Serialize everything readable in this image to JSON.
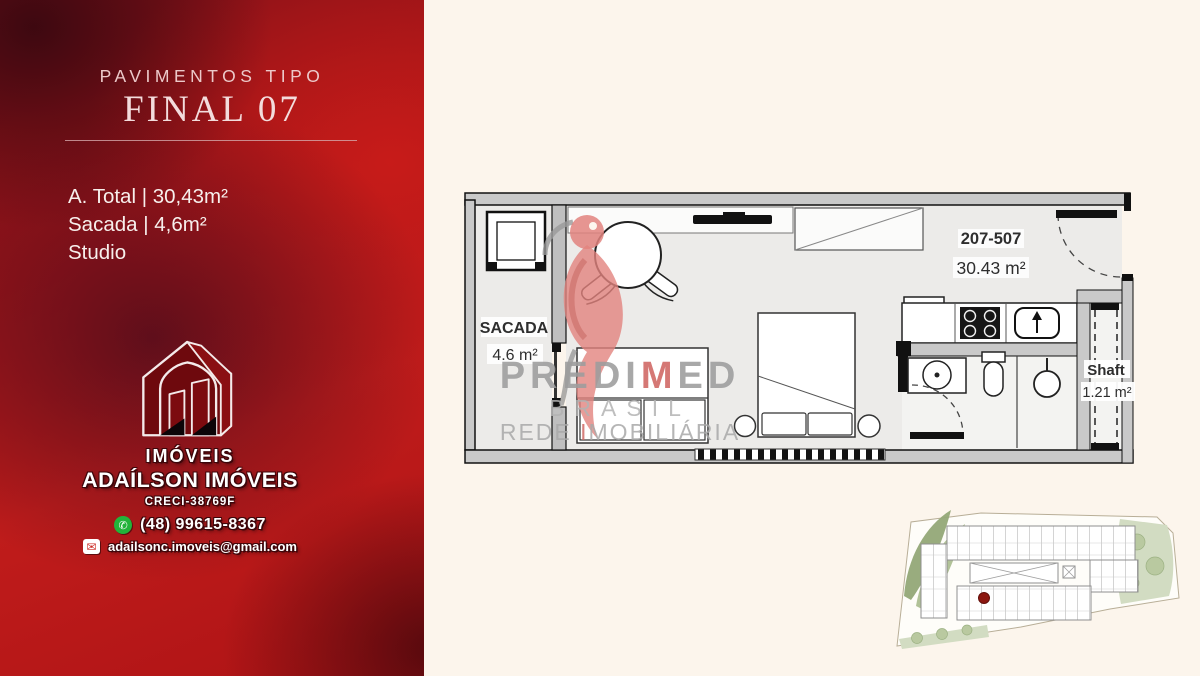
{
  "left_panel": {
    "heading_small": "PAVIMENTOS TIPO",
    "heading_large": "FINAL 07",
    "specs": [
      "A. Total | 30,43m²",
      "Sacada | 4,6m²",
      "Studio"
    ],
    "agency": {
      "brand_top": "IMÓVEIS",
      "brand_name": "ADAÍLSON IMÓVEIS",
      "creci": "CRECI-38769F",
      "phone": "(48) 99615-8367",
      "email": "adailsonc.imoveis@gmail.com"
    }
  },
  "floor_plan": {
    "balcony_label": "SACADA",
    "balcony_area": "4.6 m²",
    "unit_range": "207-507",
    "unit_area": "30.43 m²",
    "shaft_label": "Shaft",
    "shaft_area": "1.21 m²"
  },
  "watermark": {
    "brand_pre": "PREDI",
    "brand_accent": "M",
    "brand_post": "ED",
    "line2": "BRASIL",
    "line3_pre": "REDE ",
    "line3_accent": "I",
    "line3_post": "MOBILIÁRIA"
  },
  "colors": {
    "panel_red": "#c01c1b",
    "panel_dark": "#4d0b14",
    "background_cream": "#fcf5ec",
    "wall_gray": "#c9c9c9",
    "whatsapp_green": "#23b33a",
    "marker_red": "#8c1710",
    "watermark_gray": "#9d9d9d",
    "watermark_accent": "#d06663"
  }
}
